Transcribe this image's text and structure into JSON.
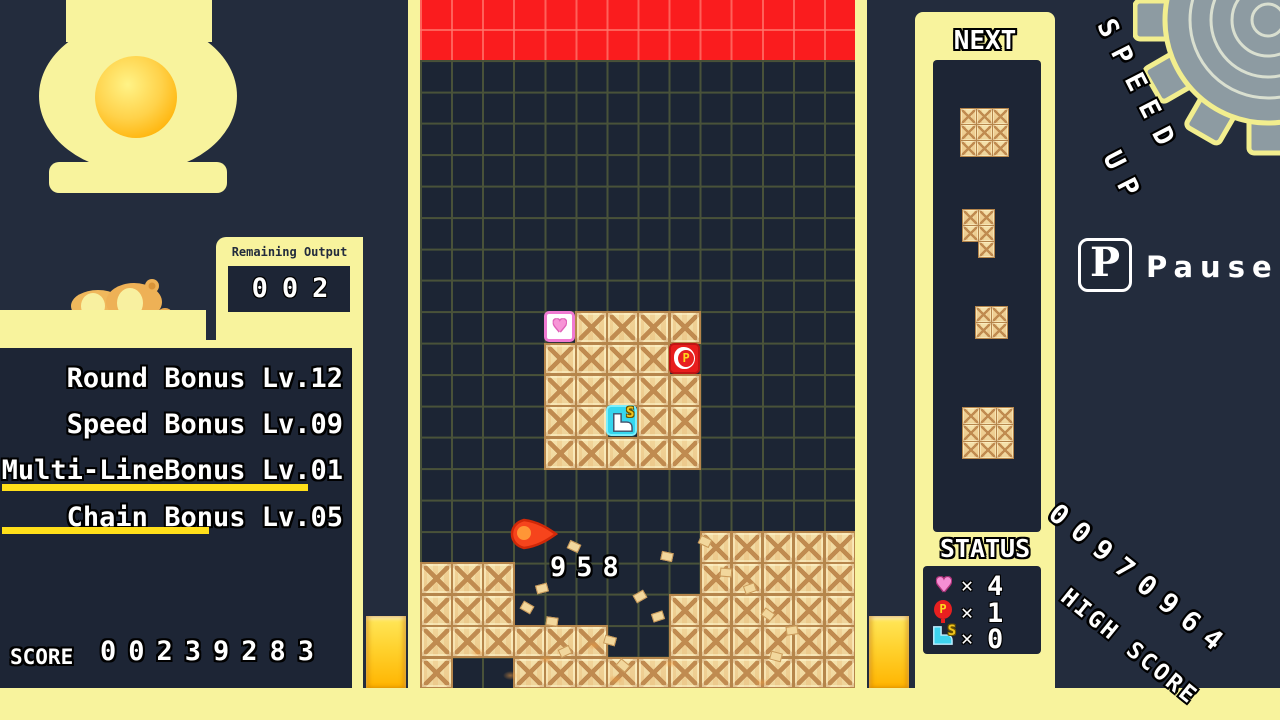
{
  "colors": {
    "background": "#232c3d",
    "panel_yellow": "#f8f39d",
    "board_bg": "#1c2534",
    "grid_line": "#495239",
    "danger_red": "#fa1c1e",
    "gauge_gold": "#ffd22e",
    "crate_tan": "#f3dfa8",
    "crate_line": "#c08b50",
    "heart_pink": "#f07ad2",
    "balloon_red": "#e81d1d",
    "boot_cyan": "#35d6ee",
    "underline_yellow": "#ffdf1a"
  },
  "left_panel": {
    "remaining_output": {
      "label": "Remaining Output",
      "value": "002"
    },
    "bonuses": [
      {
        "text": "Round Bonus Lv.12",
        "underlined": false
      },
      {
        "text": "Speed Bonus Lv.09",
        "underlined": false
      },
      {
        "text": "Multi-LineBonus Lv.01",
        "underlined": true
      },
      {
        "text": "Chain Bonus Lv.05",
        "underlined": true
      }
    ],
    "score": {
      "label": "SCORE",
      "value": "00239283"
    }
  },
  "board": {
    "cols": 14,
    "rows": 20,
    "danger_rows": 2,
    "popup_score": "958",
    "cluster": {
      "col": 4,
      "row": 8,
      "cols": 5,
      "rows": 5
    },
    "special_blocks": [
      {
        "type": "heart",
        "col": 4,
        "row": 8
      },
      {
        "type": "p-balloon",
        "col": 8,
        "row": 9
      },
      {
        "type": "boot",
        "col": 6,
        "row": 11
      }
    ],
    "terrain": [
      {
        "row": 15,
        "cols": [
          9,
          10,
          11,
          12,
          13
        ]
      },
      {
        "row": 16,
        "cols": [
          0,
          1,
          2,
          9,
          10,
          11,
          12,
          13
        ]
      },
      {
        "row": 17,
        "cols": [
          0,
          1,
          2,
          8,
          9,
          10,
          11,
          12,
          13
        ]
      },
      {
        "row": 18,
        "cols": [
          0,
          1,
          2,
          3,
          4,
          5,
          8,
          9,
          10,
          11,
          12,
          13
        ]
      },
      {
        "row": 19,
        "cols": [
          0,
          3,
          4,
          5,
          6,
          7,
          8,
          9,
          10,
          11,
          12,
          13
        ]
      }
    ],
    "fireball": {
      "x": 510,
      "y": 518
    },
    "debris_chips": [
      [
        568,
        542,
        25
      ],
      [
        536,
        584,
        -15
      ],
      [
        521,
        603,
        30
      ],
      [
        546,
        617,
        8
      ],
      [
        559,
        647,
        -25
      ],
      [
        604,
        636,
        15
      ],
      [
        617,
        661,
        40
      ],
      [
        634,
        592,
        -30
      ],
      [
        661,
        552,
        12
      ],
      [
        699,
        537,
        25
      ],
      [
        744,
        584,
        -20
      ],
      [
        762,
        610,
        35
      ],
      [
        770,
        652,
        15
      ],
      [
        786,
        626,
        -8
      ],
      [
        720,
        568,
        5
      ],
      [
        652,
        612,
        -18
      ]
    ],
    "dust": [
      [
        470,
        648
      ],
      [
        503,
        671
      ],
      [
        539,
        655
      ],
      [
        557,
        688
      ],
      [
        586,
        641
      ],
      [
        608,
        675
      ],
      [
        643,
        694
      ],
      [
        663,
        659
      ],
      [
        700,
        686
      ],
      [
        754,
        678
      ],
      [
        532,
        706
      ],
      [
        574,
        710
      ],
      [
        615,
        704
      ],
      [
        656,
        710
      ],
      [
        806,
        698
      ],
      [
        965,
        706
      ],
      [
        700,
        712
      ],
      [
        450,
        700
      ]
    ]
  },
  "next_panel": {
    "label": "NEXT",
    "pieces": [
      {
        "x": 960,
        "y": 108,
        "cell": 16,
        "cells": [
          [
            0,
            0
          ],
          [
            1,
            0
          ],
          [
            2,
            0
          ],
          [
            0,
            1
          ],
          [
            1,
            1
          ],
          [
            2,
            1
          ],
          [
            0,
            2
          ],
          [
            1,
            2
          ],
          [
            2,
            2
          ]
        ]
      },
      {
        "x": 962,
        "y": 209,
        "cell": 16,
        "cells": [
          [
            0,
            0
          ],
          [
            1,
            0
          ],
          [
            0,
            1
          ],
          [
            1,
            1
          ],
          [
            1,
            2
          ]
        ]
      },
      {
        "x": 975,
        "y": 306,
        "cell": 16,
        "cells": [
          [
            0,
            0
          ],
          [
            1,
            0
          ],
          [
            0,
            1
          ],
          [
            1,
            1
          ]
        ]
      },
      {
        "x": 962,
        "y": 407,
        "cell": 17,
        "cells": [
          [
            0,
            0
          ],
          [
            1,
            0
          ],
          [
            2,
            0
          ],
          [
            0,
            1
          ],
          [
            1,
            1
          ],
          [
            2,
            1
          ],
          [
            0,
            2
          ],
          [
            1,
            2
          ],
          [
            2,
            2
          ]
        ]
      }
    ]
  },
  "status_panel": {
    "label": "STATUS",
    "multiplier_symbol": "✕",
    "items": [
      {
        "icon": "heart",
        "count": "4"
      },
      {
        "icon": "p-balloon",
        "count": "1"
      },
      {
        "icon": "boot",
        "count": "0"
      }
    ]
  },
  "right_area": {
    "speed_up_line1": "SPEED",
    "speed_up_line2": "UP",
    "pause_key": "P",
    "pause_label": "Pause",
    "high_score_value": "00970964",
    "high_score_label": "HIGH SCORE"
  }
}
